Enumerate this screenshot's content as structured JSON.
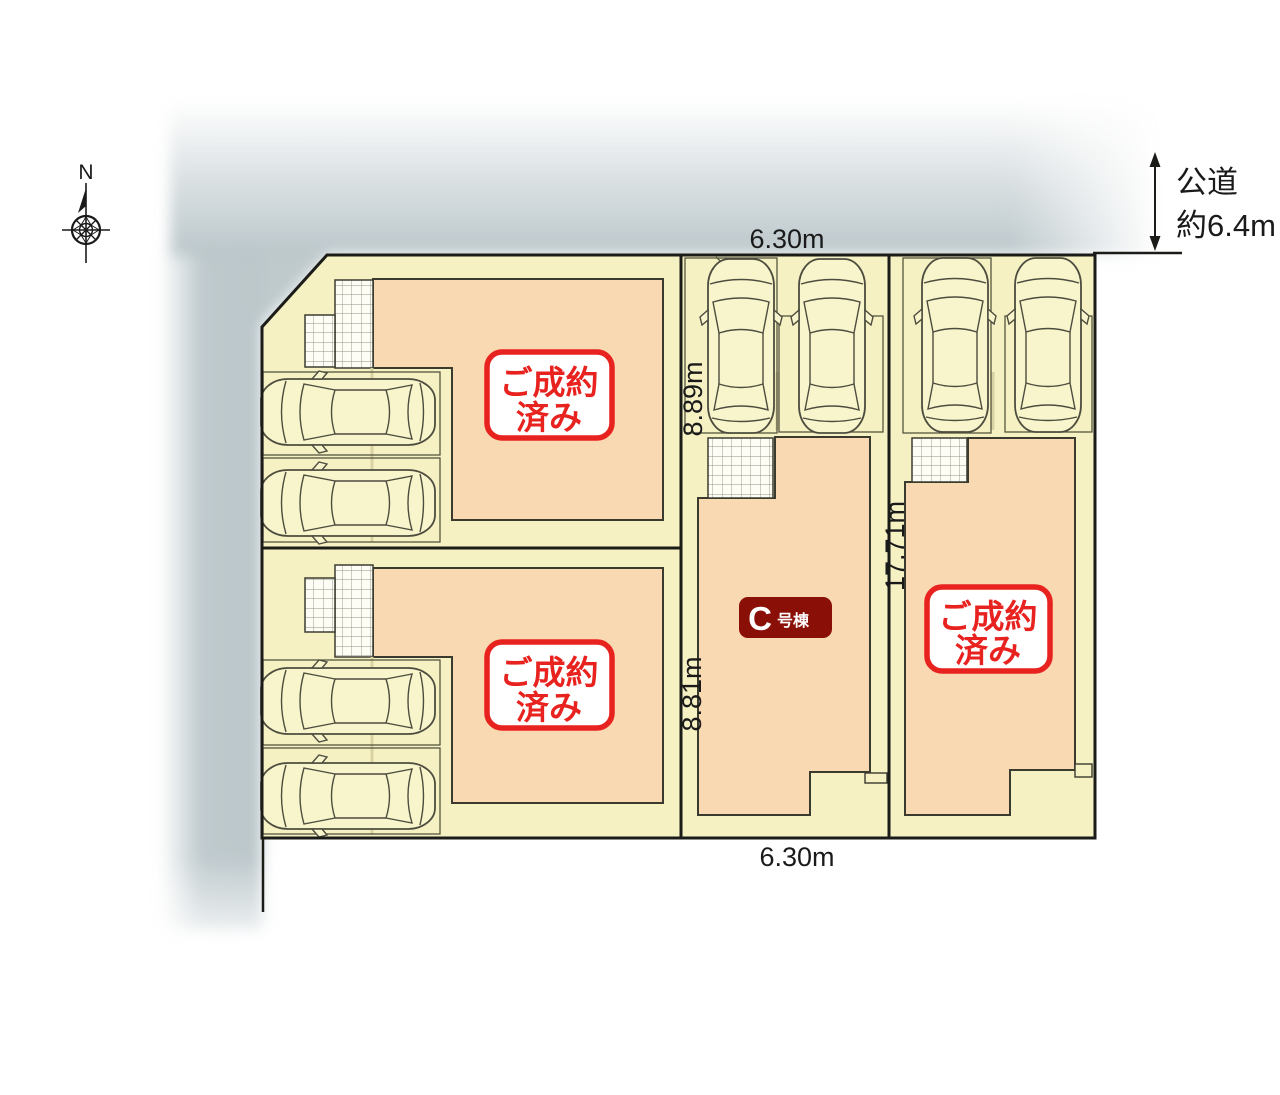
{
  "compass": {
    "north": "N"
  },
  "road": {
    "name": "公道",
    "width": "約6.4m"
  },
  "dimensions": {
    "frontage_top": "6.30m",
    "frontage_bottom": "6.30m",
    "depth_upper": "8.89m",
    "depth_lower": "8.81m",
    "depth_full": "17.71m"
  },
  "lots": {
    "top_left": {
      "status": [
        "ご成約",
        "済み"
      ]
    },
    "bottom_left": {
      "status": [
        "ご成約",
        "済み"
      ]
    },
    "middle": {
      "name_letter": "C",
      "name_suffix": "号棟"
    },
    "right": {
      "status": [
        "ご成約",
        "済み"
      ]
    }
  },
  "colors": {
    "lot_fill": "#f6f1c3",
    "building_fill": "#f9d9b2",
    "sold_badge_red": "#e8231f",
    "unit_badge_maroon": "#8a0f07",
    "shadow_gray": "#b8c4c8"
  }
}
